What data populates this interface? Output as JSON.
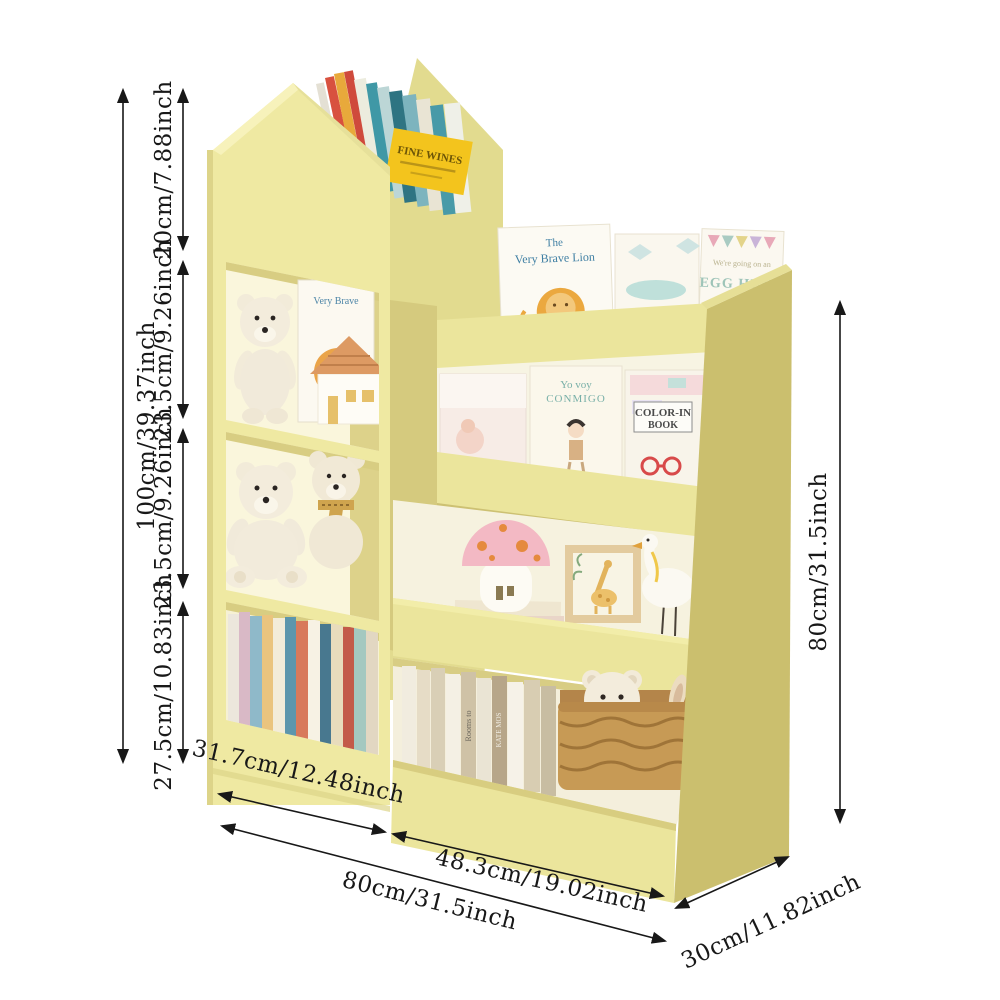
{
  "dimensions": {
    "total_height": "100cm/39.37inch",
    "seg_top": "20cm/7.88inch",
    "seg_upper_mid": "23.5cm/9.26inch",
    "seg_lower_mid": "23.5cm/9.26inch",
    "seg_bottom": "27.5cm/10.83inch",
    "right_height": "80cm/31.5inch",
    "width_left": "31.7cm/12.48inch",
    "width_right": "48.3cm/19.02inch",
    "width_total": "80cm/31.5inch",
    "depth": "30cm/11.82inch"
  },
  "books": {
    "fine_wines": "FINE WINES",
    "lion_the": "The",
    "lion_title": "Very Brave Lion",
    "tower_lion": "Very Brave",
    "egg_hunt_top": "We're going on an",
    "egg_hunt": "EGG HUNT",
    "yo_voy_1": "Yo voy",
    "yo_voy_2": "CONMIGO",
    "color_in_1": "COLOR-IN",
    "color_in_2": "BOOK",
    "spine_rooms": "Rooms to",
    "spine_kate": "KATE MOS",
    "spine_wizard": "THE WIZARD"
  },
  "colors": {
    "front_yellow": "#efe9a2",
    "side_yellow": "#cdc173",
    "dim_line": "#181818"
  }
}
